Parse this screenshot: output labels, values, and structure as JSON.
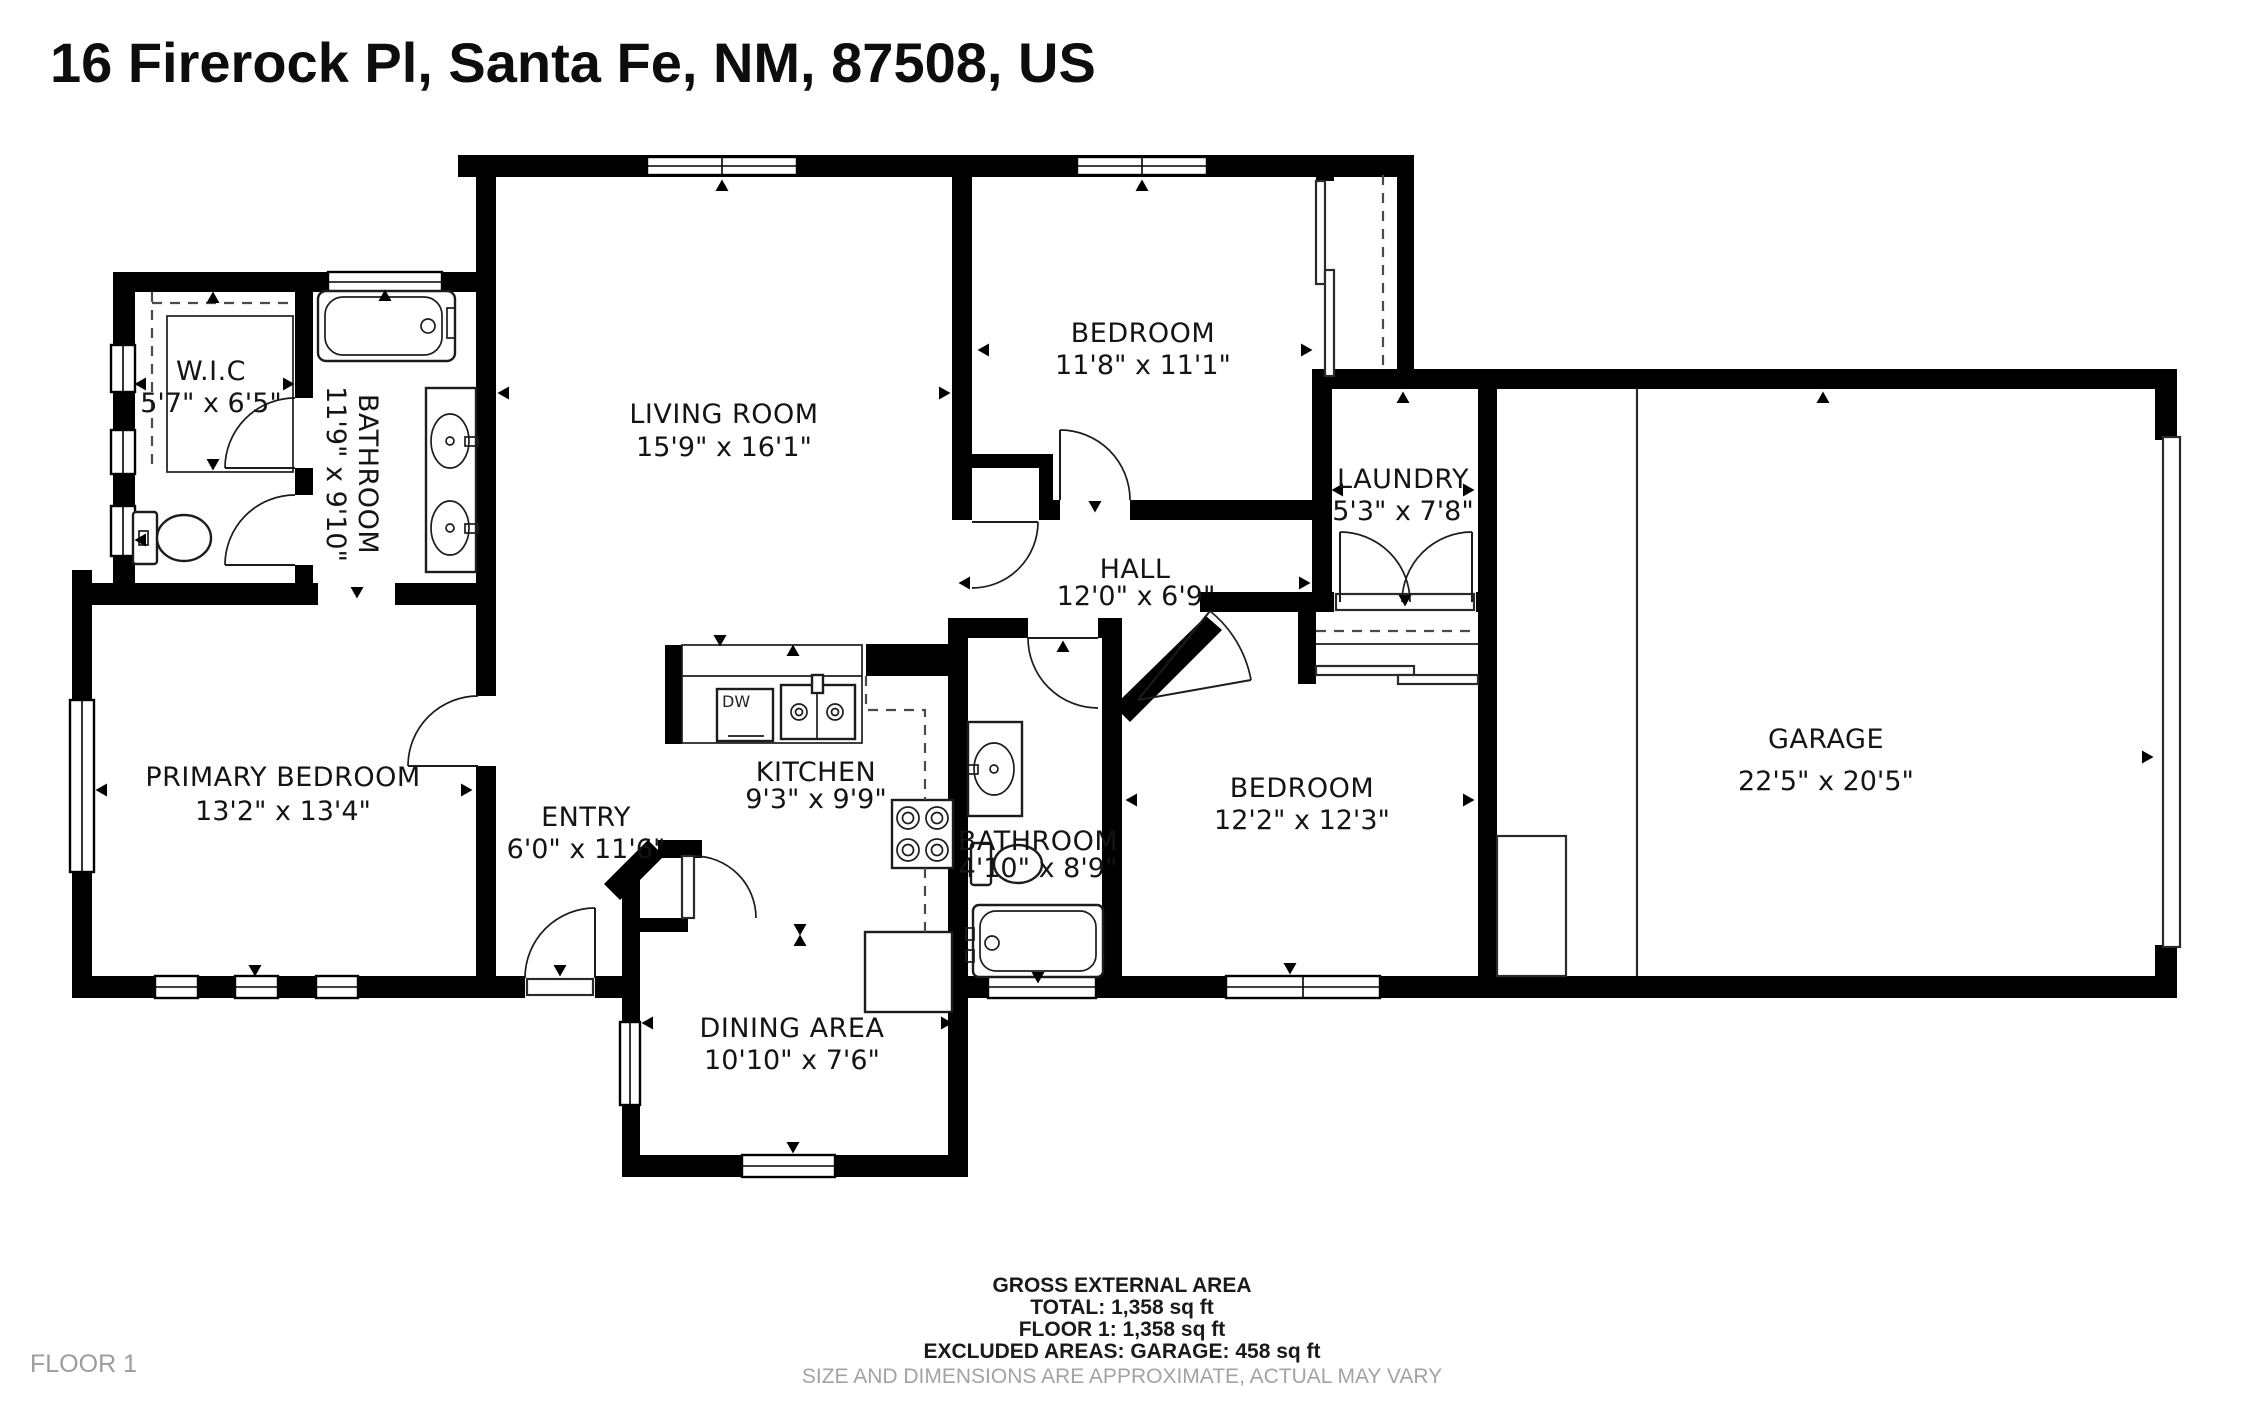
{
  "title": "16 Firerock Pl, Santa Fe, NM, 87508, US",
  "floor_label": "FLOOR 1",
  "rooms": {
    "wic": {
      "name": "W.I.C",
      "dims": "5'7\" x 6'5\""
    },
    "bathroom1": {
      "name": "BATHROOM",
      "dims": "11'9\" x 9'10\""
    },
    "living": {
      "name": "LIVING ROOM",
      "dims": "15'9\" x 16'1\""
    },
    "bedroom1": {
      "name": "BEDROOM",
      "dims": "11'8\" x 11'1\""
    },
    "laundry": {
      "name": "LAUNDRY",
      "dims": "5'3\" x 7'8\""
    },
    "hall": {
      "name": "HALL",
      "dims": "12'0\" x 6'9\""
    },
    "garage": {
      "name": "GARAGE",
      "dims": "22'5\" x 20'5\""
    },
    "primary": {
      "name": "PRIMARY BEDROOM",
      "dims": "13'2\" x 13'4\""
    },
    "entry": {
      "name": "ENTRY",
      "dims": "6'0\" x 11'6\""
    },
    "kitchen": {
      "name": "KITCHEN",
      "dims": "9'3\" x 9'9\""
    },
    "bathroom2": {
      "name": "BATHROOM",
      "dims": "4'10\" x 8'9\""
    },
    "bedroom2": {
      "name": "BEDROOM",
      "dims": "12'2\" x 12'3\""
    },
    "dining": {
      "name": "DINING AREA",
      "dims": "10'10\" x 7'6\""
    }
  },
  "fixtures": {
    "dishwasher": "DW"
  },
  "footer": {
    "line1": "GROSS EXTERNAL AREA",
    "line2": "TOTAL: 1,358 sq ft",
    "line3": "FLOOR 1: 1,358 sq ft",
    "line4": "EXCLUDED AREAS: GARAGE: 458 sq ft",
    "disclaimer": "SIZE AND DIMENSIONS ARE APPROXIMATE, ACTUAL MAY VARY"
  },
  "colors": {
    "wall": "#000000",
    "background": "#ffffff",
    "label": "#141414",
    "muted": "#9c9c9c"
  }
}
